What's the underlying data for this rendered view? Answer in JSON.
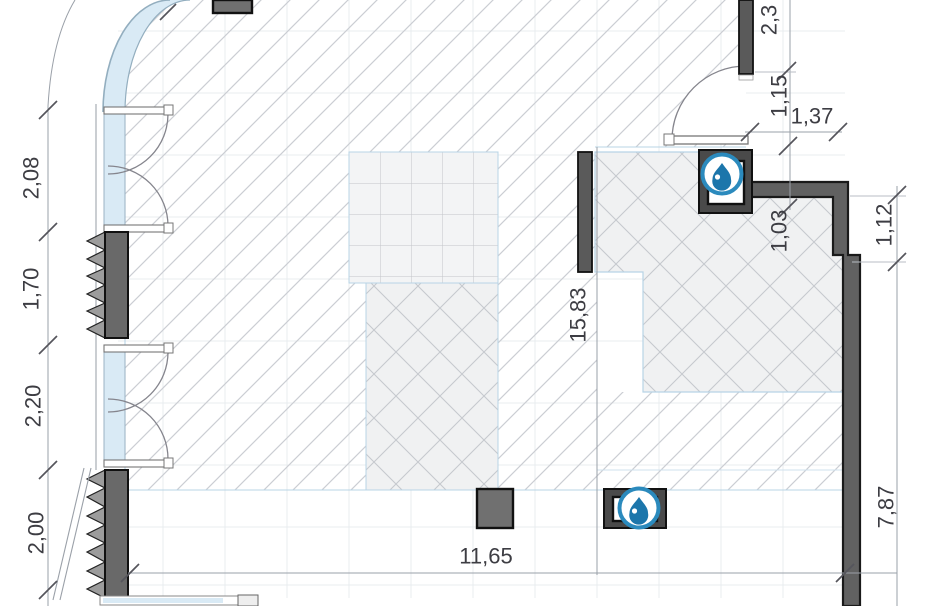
{
  "drawing": {
    "kind": "architectural-floor-plan"
  },
  "dimensions": {
    "left": {
      "d208": "2,08",
      "d170": "1,70",
      "d220": "2,20",
      "d200": "2,00"
    },
    "center": {
      "d1583": "15,83",
      "d1165": "11,65"
    },
    "right": {
      "d23": "2,3",
      "d115": "1,15",
      "d137": "1,37",
      "d103": "1,03",
      "d112": "1,12",
      "d787": "7,87"
    }
  },
  "icons": {
    "fixture_top": "water-drop-icon",
    "fixture_bottom": "water-drop-icon"
  },
  "colors": {
    "accent_blue": "#2b8abd",
    "drop_blue": "#1c76ab",
    "wall_gray": "#616161",
    "insulation_gray": "#9c9c9c",
    "glazing_blue": "#d9eaf5",
    "hatch_gray": "#cbced3",
    "boundary_blue": "#b8d4e6",
    "dim_line_gray": "#9aa0a8",
    "dim_text_gray": "#3d3d43"
  }
}
